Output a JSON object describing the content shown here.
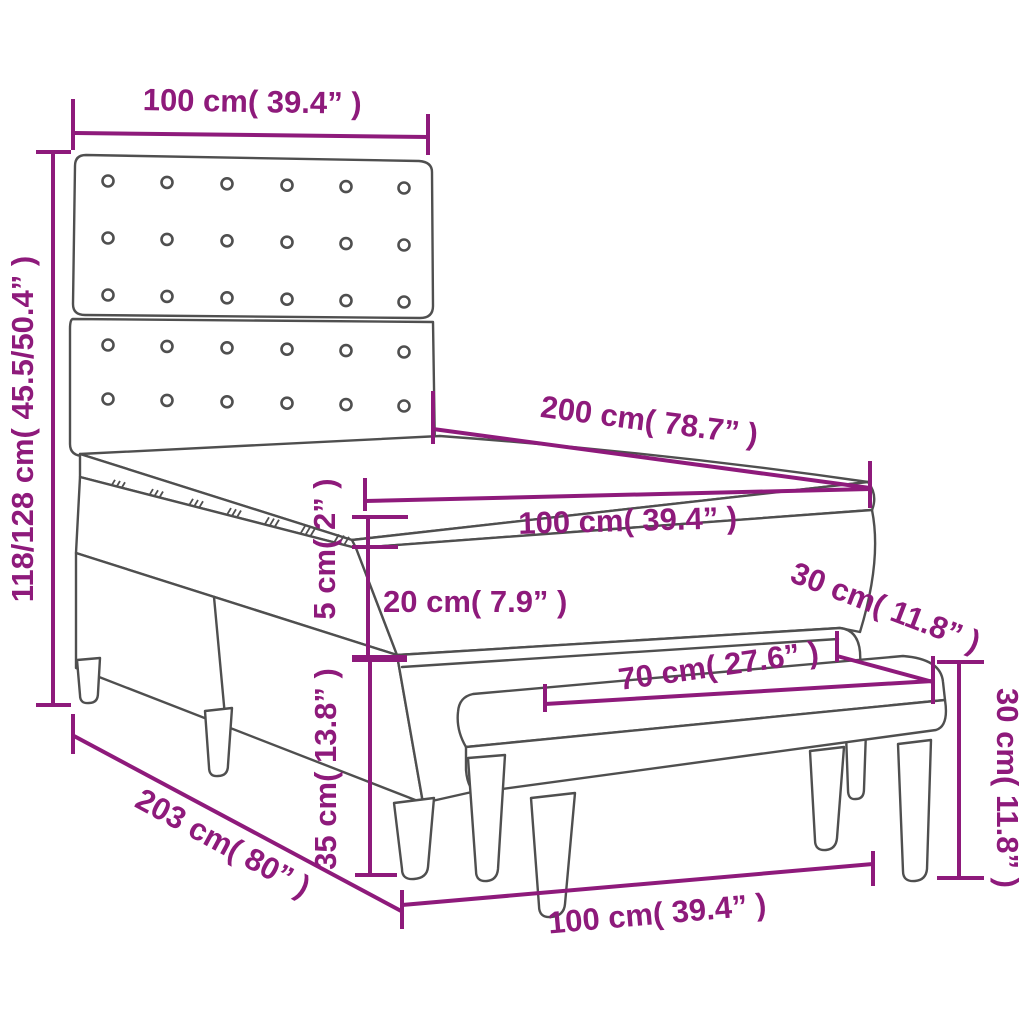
{
  "figure": {
    "type": "product-dimension-diagram",
    "product": "box spring bed with tufted headboard, mattress, topper and bench",
    "colors": {
      "dimension_accent": "#8e1a7b",
      "drawing_outline": "#4f4f4f",
      "background": "#ffffff"
    },
    "labels": {
      "headboard_width": "100 cm( 39.4” )",
      "overall_height": "118/128 cm( 45.5/50.4” )",
      "mattress_length": "200 cm( 78.7” )",
      "mattress_width": "100 cm( 39.4” )",
      "topper_height": "5 cm( 2” )",
      "mattress_height": "20 cm( 7.9” )",
      "bench_depth": "30 cm( 11.8” )",
      "bench_seat_length": "70 cm( 27.6” )",
      "base_height": "35 cm( 13.8” )",
      "bed_length": "203 cm( 80” )",
      "bench_height": "30 cm( 11.8” )",
      "bench_length": "100 cm( 39.4” )"
    }
  }
}
